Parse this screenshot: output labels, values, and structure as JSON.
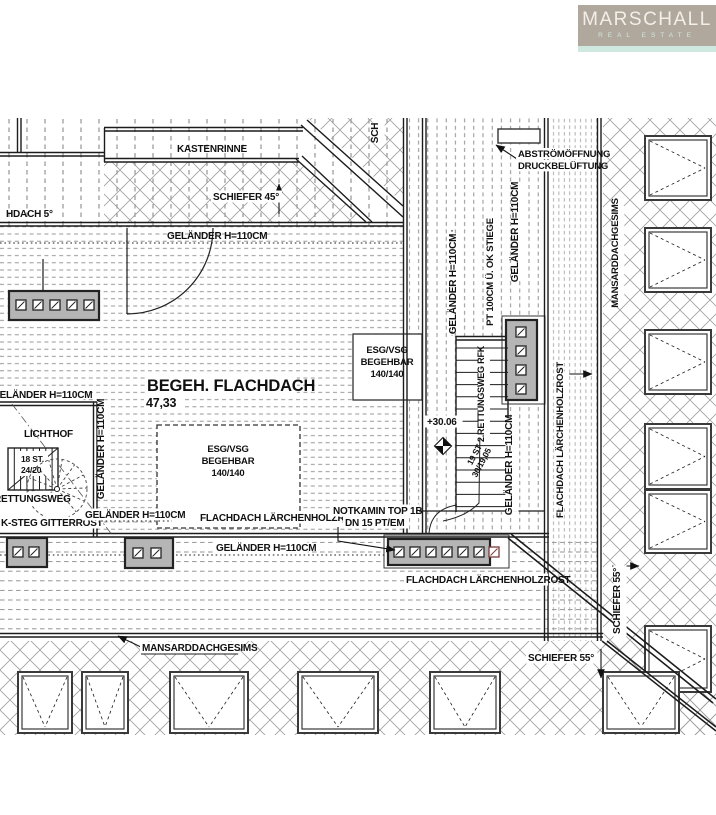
{
  "logo": {
    "brand": "MARSCHALL",
    "tagline": "REAL ESTATE",
    "bg": "#b1a89d",
    "text_color": "#f2efe9",
    "accent": "#cfe8e0"
  },
  "colors": {
    "line": "#1c1c1c",
    "hatch": "#9b9b9b",
    "dash": "#7f7f7f",
    "box_fill": "#b5b5b5",
    "vent_red": "#7a3b3b",
    "paper": "#ffffff"
  },
  "drawing": {
    "labels": {
      "kastenrinne": {
        "text": "KASTENRINNE"
      },
      "schiefer45": {
        "text": "SCHIEFER 45°"
      },
      "flachdach5": {
        "text": "HDACH 5°"
      },
      "gelaender_top": {
        "text": "GELÄNDER H=110CM"
      },
      "abstroem_1": {
        "text": "ABSTRÖMÖFFNUNG"
      },
      "abstroem_2": {
        "text": "DRUCKBELÜFTUNG"
      },
      "sch_partial": {
        "text": "SCH"
      },
      "begehbar_title": {
        "text": "BEGEH. FLACHDACH"
      },
      "begehbar_value": {
        "text": "47,33"
      },
      "gelaender_left": {
        "text": "GELÄNDER H=110CM"
      },
      "lichthof": {
        "text": "LICHTHOF"
      },
      "stairs_small_1": {
        "text": "18 ST."
      },
      "stairs_small_2": {
        "text": "24/20"
      },
      "rettungsweg": {
        "text": "RETTUNGSWEG"
      },
      "ksteg": {
        "text": "K-STEG GITTERROST"
      },
      "gelaender_lichthof": {
        "text": "GELÄNDER H=110CM"
      },
      "rost_bottom_1": {
        "text": "FLACHDACH LÄRCHENHOLZROST"
      },
      "gelaender_bottom": {
        "text": "GELÄNDER H=110CM"
      },
      "notkamin_1": {
        "text": "NOTKAMIN TOP 1B"
      },
      "notkamin_2": {
        "text": "DN 15 PT/EM"
      },
      "rost_bottom_2": {
        "text": "FLACHDACH LÄRCHENHOLZROST"
      },
      "esg1_1": {
        "text": "ESG/VSG"
      },
      "esg1_2": {
        "text": "BEGEHBAR"
      },
      "esg1_3": {
        "text": "140/140"
      },
      "esg2_1": {
        "text": "ESG/VSG"
      },
      "esg2_2": {
        "text": "BEGEHBAR"
      },
      "esg2_3": {
        "text": "140/140"
      },
      "level": {
        "text": "+30.06"
      },
      "mansard_bottom": {
        "text": "MANSARDDACHGESIMS"
      },
      "schiefer55_h": {
        "text": "SCHIEFER 55°"
      },
      "v_gel1": {
        "text": "GELÄNDER H=110CM"
      },
      "v_pt": {
        "text": "PT 100CM Ü. OK STIEGE"
      },
      "v_gel2": {
        "text": "GELÄNDER H=110CM"
      },
      "v_rett": {
        "text": "2.RETTUNGSWEG RFK"
      },
      "v_gel3": {
        "text": "GELÄNDER H=110CM"
      },
      "v_gel4": {
        "text": "GELÄNDER H=110CM"
      },
      "v_rost": {
        "text": "FLACHDACH LÄRCHENHOLZROST"
      },
      "v_mansard": {
        "text": "MANSARDDACHGESIMS"
      },
      "v_schiefer55": {
        "text": "SCHIEFER 55°"
      },
      "stair_steps_1": {
        "text": "19 ST"
      },
      "stair_steps_2": {
        "text": "30/19,05"
      }
    }
  }
}
